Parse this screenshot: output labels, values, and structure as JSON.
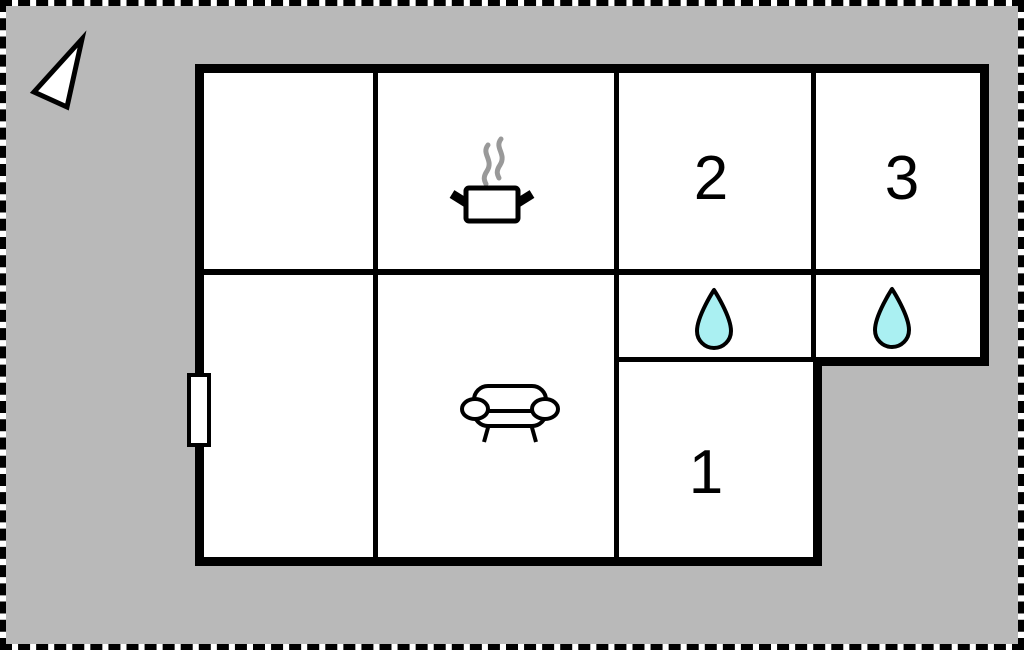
{
  "floorplan": {
    "title": "floor-plan",
    "rooms": [
      {
        "name": "bedroom-2",
        "label": "2"
      },
      {
        "name": "bedroom-3",
        "label": "3"
      },
      {
        "name": "bedroom-1",
        "label": "1"
      }
    ],
    "icons": {
      "compass": "north-arrow",
      "kitchen": "cooking-pot-with-steam",
      "living_room": "sofa",
      "bathroom_2": "water-drop",
      "bathroom_3": "water-drop",
      "entrance": "door"
    },
    "colors": {
      "background": "#b9b9b9",
      "floor": "#ffffff",
      "wall": "#000000",
      "water_drop": "#aaf0f2",
      "steam": "#999999"
    }
  }
}
